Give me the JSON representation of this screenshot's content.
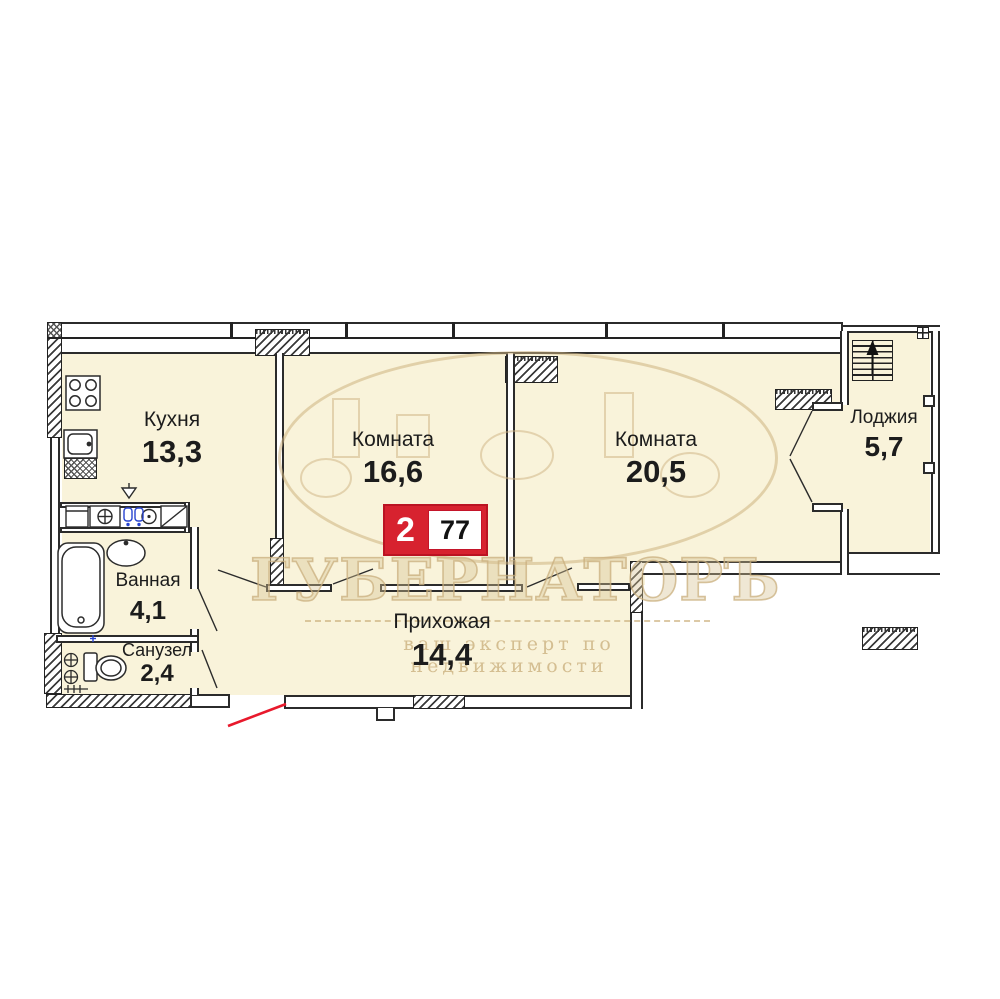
{
  "floor_plan": {
    "rooms": [
      {
        "name": "Кухня",
        "area": "13,3"
      },
      {
        "name": "Комната",
        "area": "16,6"
      },
      {
        "name": "Комната",
        "area": "20,5"
      },
      {
        "name": "Лоджия",
        "area": "5,7"
      },
      {
        "name": "Ванная",
        "area": "4,1"
      },
      {
        "name": "Санузел",
        "area": "2,4"
      },
      {
        "name": "Прихожая",
        "area": "14,4"
      }
    ],
    "badge": {
      "rooms_count": "2",
      "total_area": "77"
    },
    "watermark": {
      "brand": "ГУБЕРНАТОРЪ",
      "tagline": "ваш эксперт по недвижимости"
    },
    "colors": {
      "accent_red": "#D7222F",
      "entry_door_red": "#E8192C",
      "floor_fill": "#F9F3DA",
      "wall_line": "#2B2B2B",
      "watermark_tint": "#D9C397"
    },
    "icons": [
      "stairs-up-icon",
      "window-grid-icon",
      "stove-icon",
      "sink-icon",
      "bathtub-icon",
      "washbasin-icon",
      "toilet-icon",
      "washing-machine-icon",
      "riser-valve-icon",
      "vent-icon",
      "door-swing",
      "entry-door-swing"
    ]
  }
}
